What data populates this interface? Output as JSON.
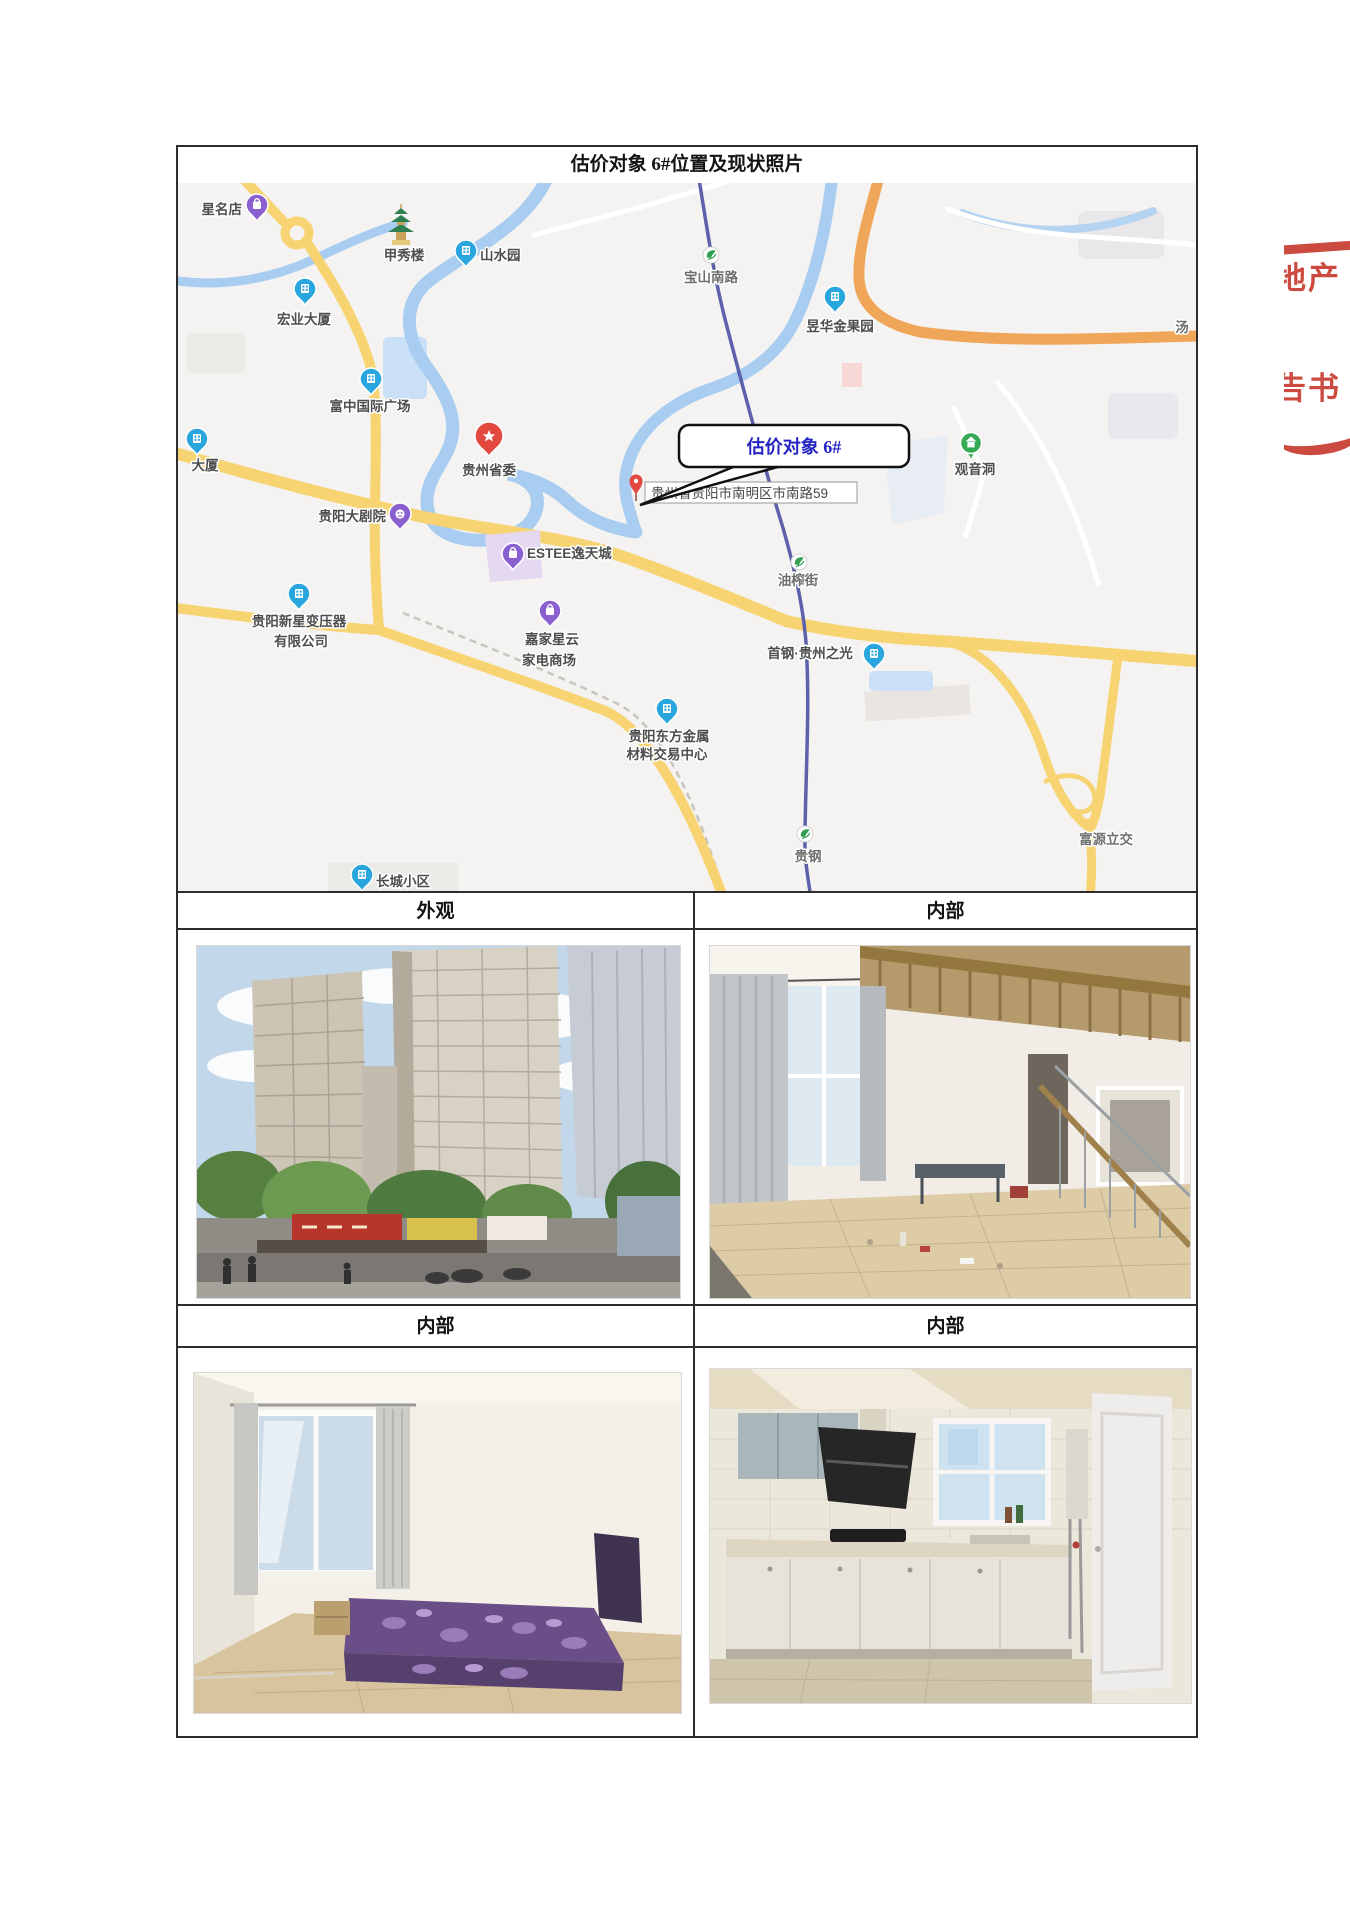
{
  "document": {
    "title": "估价对象 6#位置及现状照片"
  },
  "sections": {
    "row1_left": "外观",
    "row1_right": "内部",
    "row2_left": "内部",
    "row2_right": "内部"
  },
  "map": {
    "callout_text": "估价对象 6#",
    "address_label": "贵州省贵阳市南明区市南路59",
    "pois": {
      "xingmingdian": "星名店",
      "jiaxiulou": "甲秀楼",
      "shanshuiyuan": "山水园",
      "baoshannanlu": "宝山南路",
      "hongye": "宏业大厦",
      "yuhua": "昱华金果园",
      "fuzhong": "富中国际广场",
      "dasha": "大厦",
      "shengwei": "贵州省委",
      "guanyindong": "观音洞",
      "dajuyuan": "贵阳大剧院",
      "estee": "ESTEE逸天城",
      "youzhajie": "油榨街",
      "xinxing1": "贵阳新星变压器",
      "xinxing2": "有限公司",
      "jiajia1": "嘉家星云",
      "jiajia2": "家电商场",
      "shougang": "首钢·贵州之光",
      "dongfang1": "贵阳东方金属",
      "dongfang2": "材料交易中心",
      "guigang": "贵钢",
      "fuyuan": "富源立交",
      "changcheng": "长城小区",
      "tang": "汤"
    }
  },
  "stamp": {
    "line1": "地产",
    "line2": "告书"
  },
  "colors": {
    "map_bg": "#f4f3f1",
    "accent_blue_pin": "#29a6de",
    "accent_purple_pin": "#8a5fd0",
    "accent_red_pin": "#e2483d",
    "accent_green_pin": "#35aa55",
    "metro_green": "#2f9e4e",
    "metro_line": "#5d61ab",
    "callout_text_blue": "#2525c4",
    "stamp_red": "#c63326",
    "road_yellow": "#f7d471",
    "road_orange": "#f0a658",
    "water_blue": "#a8cdf0"
  }
}
